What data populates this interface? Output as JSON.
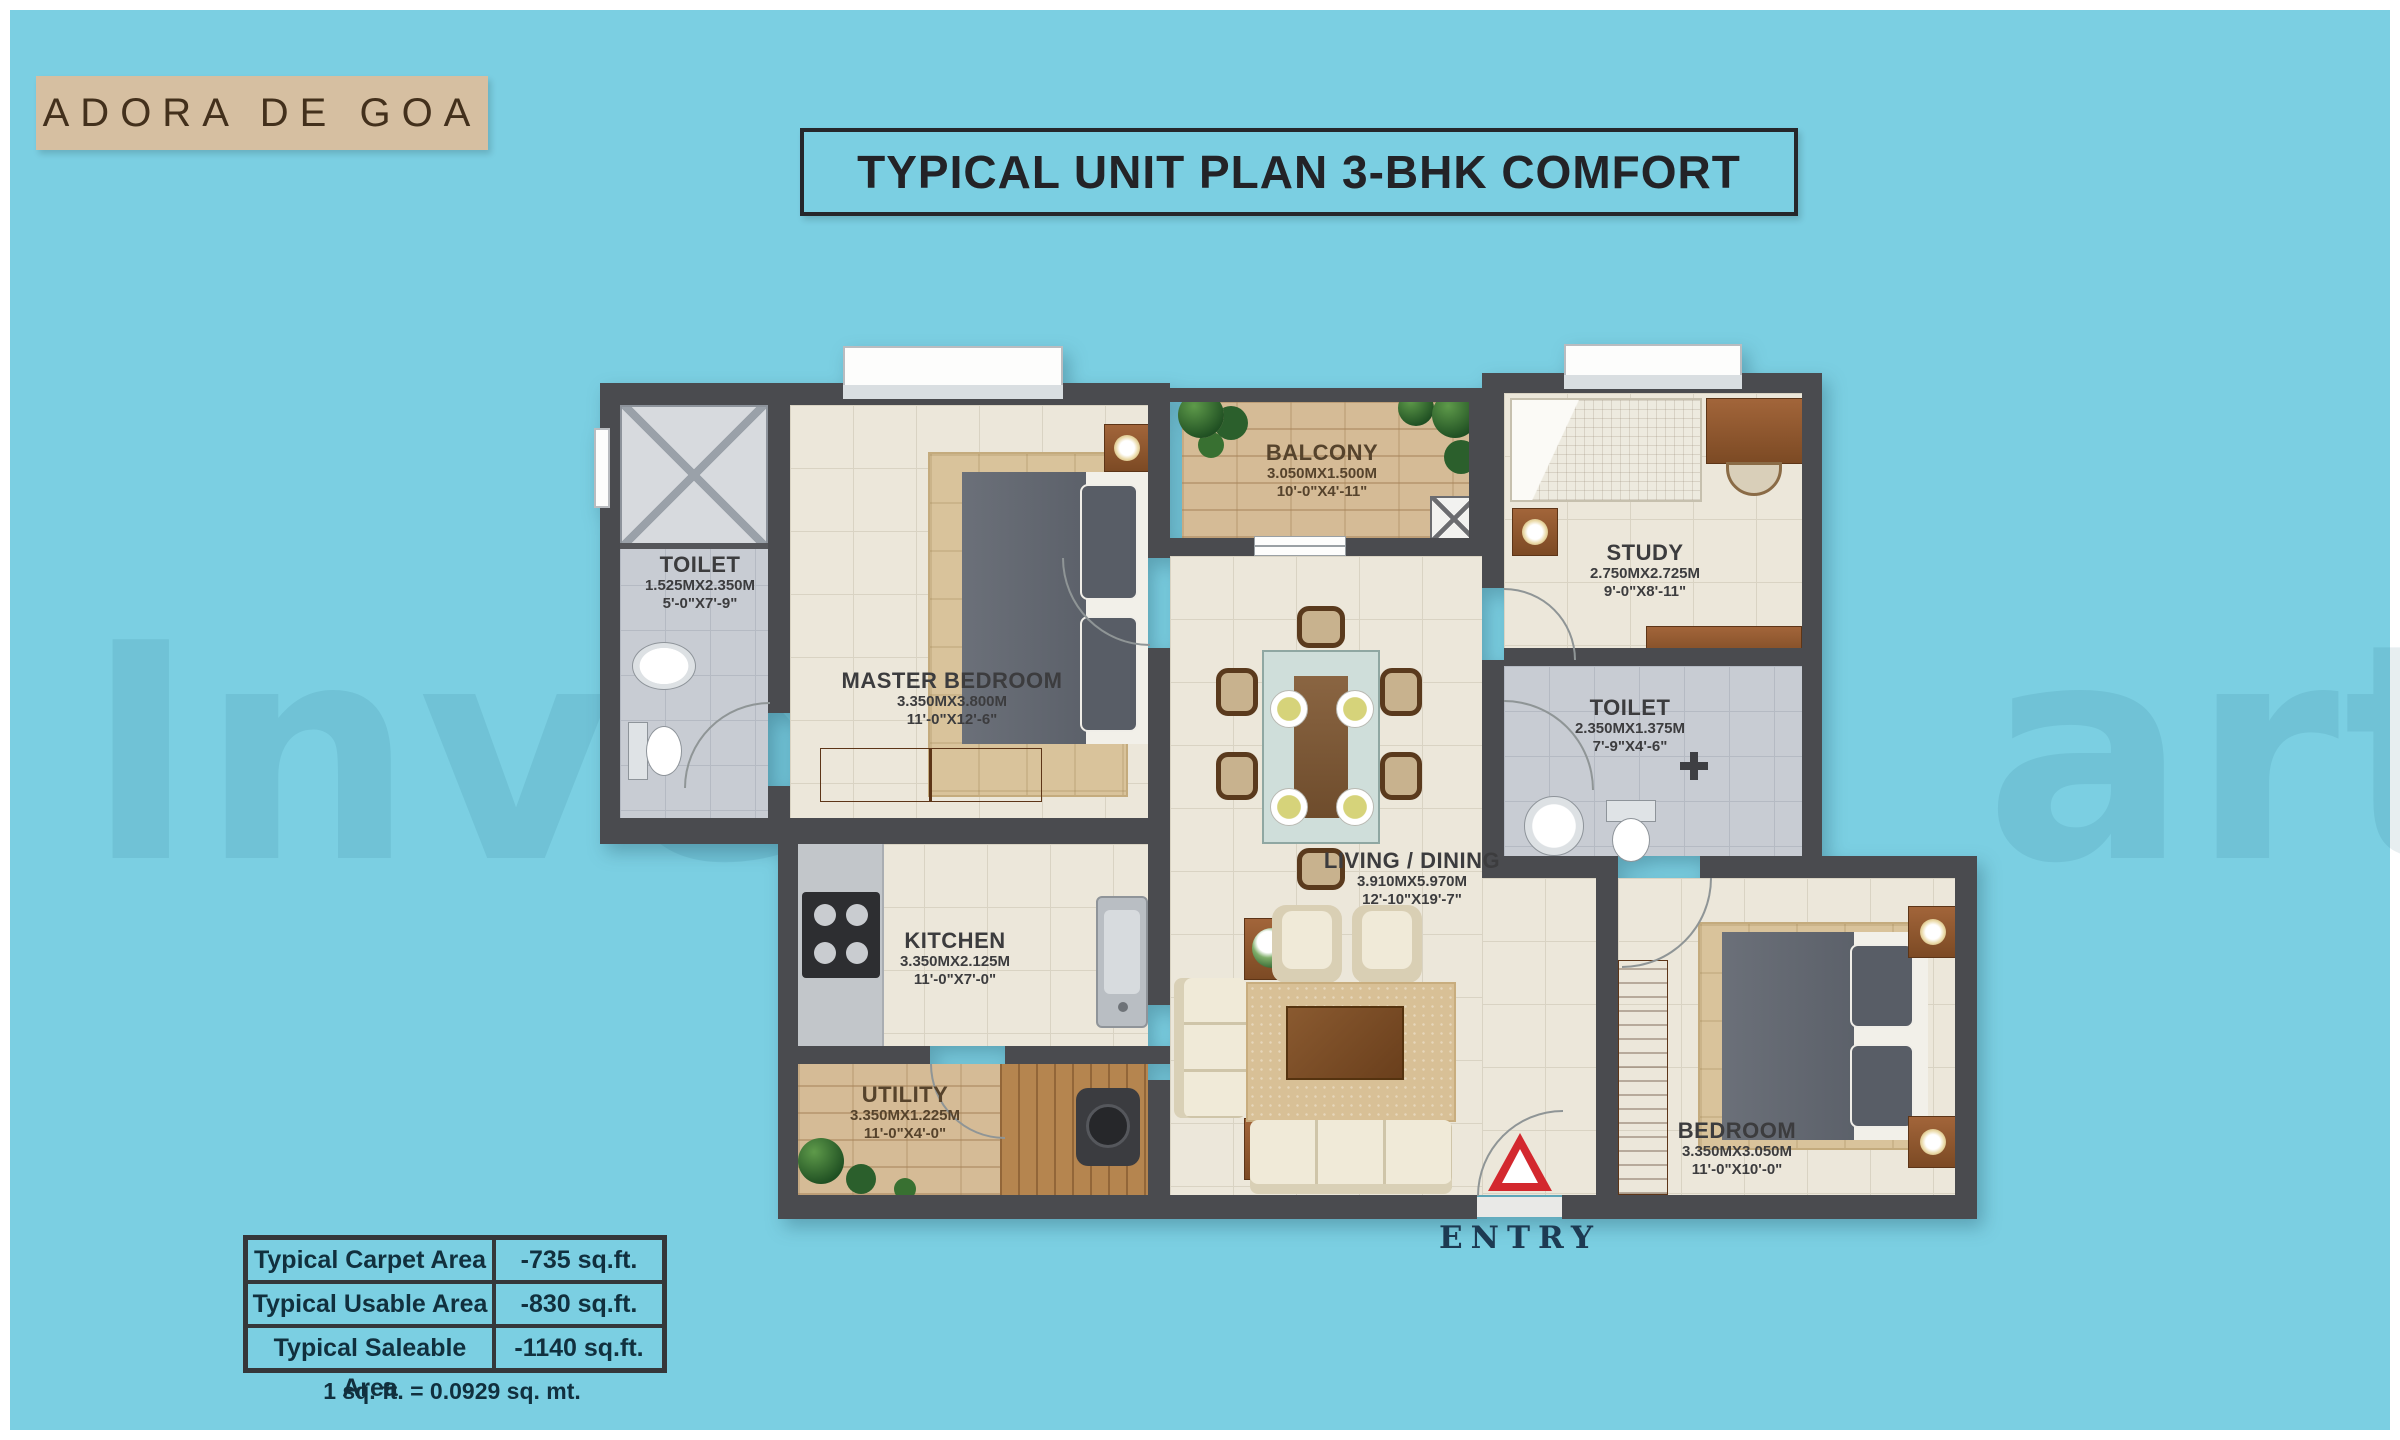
{
  "colors": {
    "background": "#7bcfe2",
    "wall": "#4a4b4f",
    "accent_red": "#d3282e",
    "logo_bg": "#d6bfa1"
  },
  "logo": {
    "text": "ADORA DE GOA"
  },
  "title": {
    "text": "TYPICAL UNIT PLAN 3-BHK COMFORT"
  },
  "watermark": {
    "left": "Inve",
    "right": "art"
  },
  "plan": {
    "entry_label": "ENTRY",
    "rooms": [
      {
        "id": "toilet-1",
        "name": "TOILET",
        "dim_m": "1.525MX2.350M",
        "dim_ft": "5'-0\"X7'-9\""
      },
      {
        "id": "master-bedroom",
        "name": "MASTER BEDROOM",
        "dim_m": "3.350MX3.800M",
        "dim_ft": "11'-0\"X12'-6\""
      },
      {
        "id": "balcony",
        "name": "BALCONY",
        "dim_m": "3.050MX1.500M",
        "dim_ft": "10'-0\"X4'-11\""
      },
      {
        "id": "study",
        "name": "STUDY",
        "dim_m": "2.750MX2.725M",
        "dim_ft": "9'-0\"X8'-11\""
      },
      {
        "id": "toilet-2",
        "name": "TOILET",
        "dim_m": "2.350MX1.375M",
        "dim_ft": "7'-9\"X4'-6\""
      },
      {
        "id": "living-dining",
        "name": "LIVING / DINING",
        "dim_m": "3.910MX5.970M",
        "dim_ft": "12'-10\"X19'-7\""
      },
      {
        "id": "kitchen",
        "name": "KITCHEN",
        "dim_m": "3.350MX2.125M",
        "dim_ft": "11'-0\"X7'-0\""
      },
      {
        "id": "utility",
        "name": "UTILITY",
        "dim_m": "3.350MX1.225M",
        "dim_ft": "11'-0\"X4'-0\""
      },
      {
        "id": "bedroom",
        "name": "BEDROOM",
        "dim_m": "3.350MX3.050M",
        "dim_ft": "11'-0\"X10'-0\""
      }
    ]
  },
  "area_table": {
    "rows": [
      {
        "label": "Typical Carpet Area",
        "value": "-735 sq.ft."
      },
      {
        "label": "Typical Usable Area",
        "value": "-830 sq.ft."
      },
      {
        "label": "Typical Saleable Area",
        "value": "-1140 sq.ft."
      }
    ],
    "note": "1 sq. ft. = 0.0929 sq. mt."
  }
}
